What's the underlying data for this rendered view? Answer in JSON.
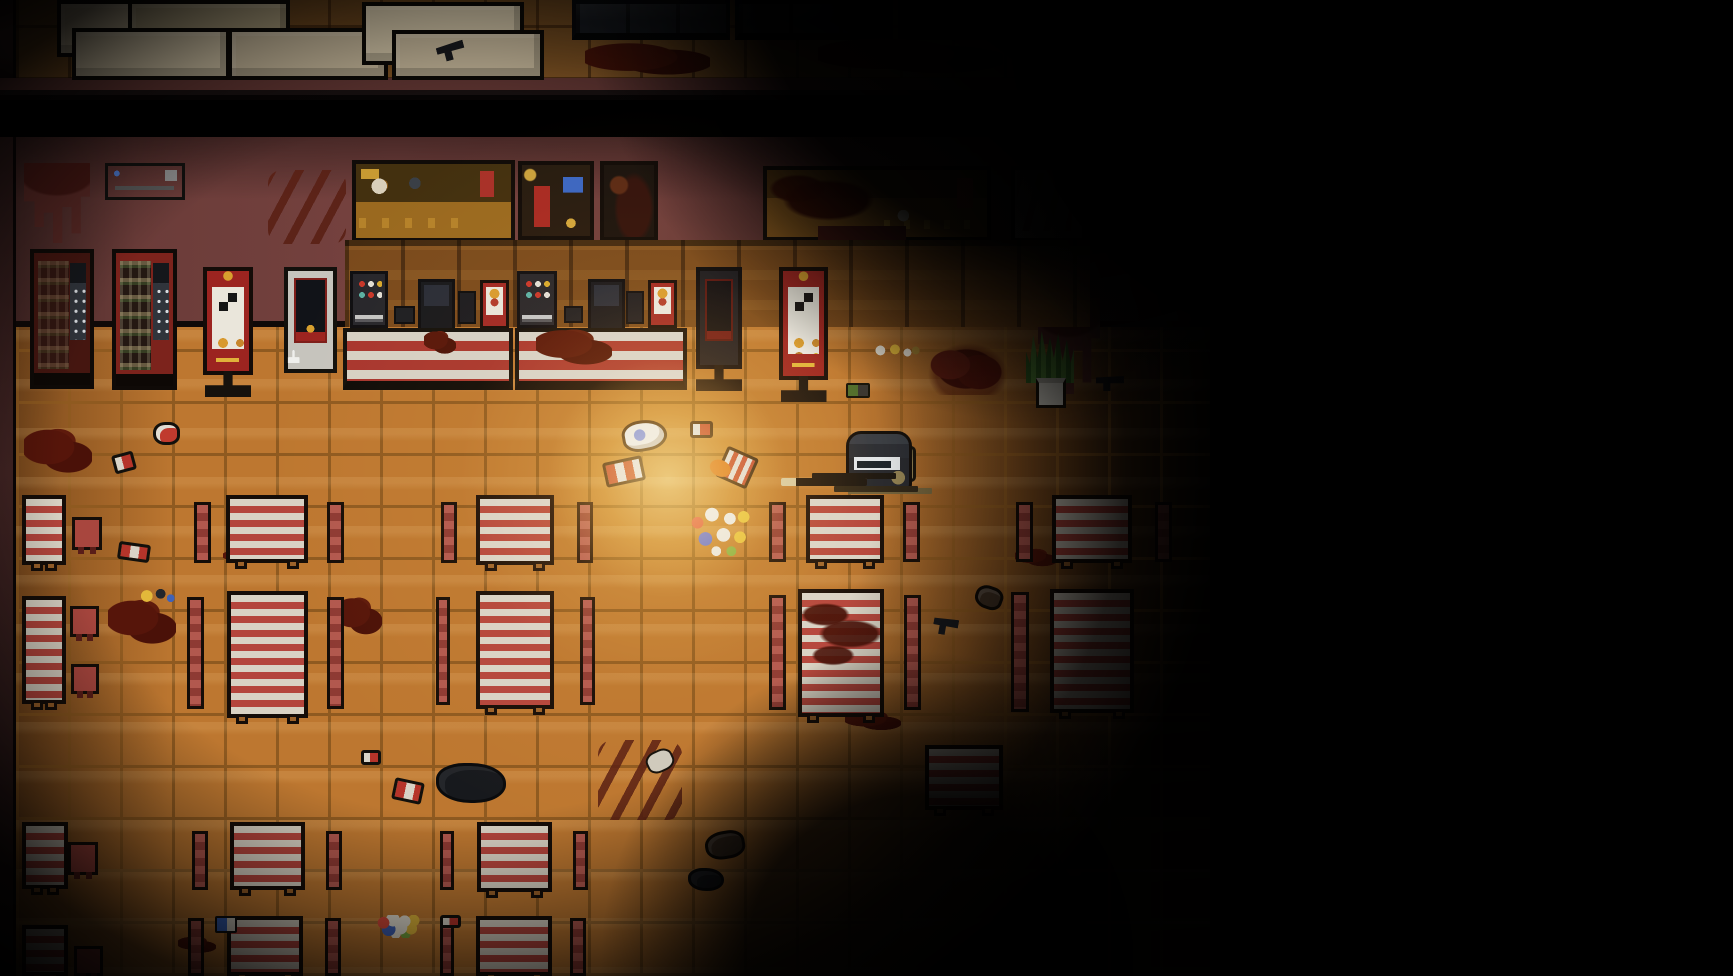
{
  "meta": {
    "scene": "top-down pixel-art fast-food restaurant interior, zombie-survival shooter",
    "lighting": "dark vignette with warm light pool around player"
  },
  "viewport": {
    "width": 1733,
    "height": 976
  },
  "palette": {
    "floor_tile": "#bd7730",
    "floor_grout": "#8f5a20",
    "wall": "#6b3c39",
    "table_stripe_red": "#b4453c",
    "table_stripe_white": "#d9d2c4",
    "bench_red": "#a84b43",
    "counter_stripe_red": "#a8362e",
    "counter_stripe_white": "#d6d0c3",
    "blood": "#4f1309",
    "wall_blood": "#5c2a26",
    "light_warm": "#ffcf7a",
    "vending_red": "#7c231c",
    "kiosk_red": "#9c2420",
    "plant_green": "#4d8033",
    "player_helmet": "#2c3138",
    "player_goggles": "#e2e5e7",
    "gun_suppressor_tan": "#d6c69a"
  },
  "entities": [
    {
      "t": "backroom-floor",
      "n": "backroom-floor",
      "x": 16,
      "y": 0,
      "w": 1074,
      "h": 80
    },
    {
      "t": "wall-left",
      "n": "backroom-left-wall",
      "x": 0,
      "y": 0,
      "w": 16,
      "h": 80
    },
    {
      "t": "wall-band",
      "n": "backroom-wall",
      "x": 0,
      "y": 78,
      "w": 1090,
      "h": 22
    },
    {
      "t": "crate",
      "v": "a",
      "n": "crate",
      "x": 57,
      "y": 0,
      "w": 100,
      "h": 57
    },
    {
      "t": "crate",
      "v": "b",
      "n": "crate",
      "x": 128,
      "y": 0,
      "w": 162,
      "h": 60
    },
    {
      "t": "crate",
      "v": "c",
      "n": "crate",
      "x": 72,
      "y": 28,
      "w": 158,
      "h": 52
    },
    {
      "t": "crate",
      "v": "a",
      "n": "crate",
      "x": 228,
      "y": 28,
      "w": 160,
      "h": 52
    },
    {
      "t": "crate",
      "v": "c",
      "n": "crate",
      "x": 362,
      "y": 2,
      "w": 162,
      "h": 63
    },
    {
      "t": "crate",
      "v": "a",
      "n": "crate",
      "x": 392,
      "y": 30,
      "w": 152,
      "h": 50
    },
    {
      "t": "shelf",
      "n": "storage-shelf",
      "x": 572,
      "y": 0,
      "w": 158,
      "h": 40
    },
    {
      "t": "shelf",
      "n": "storage-shelf",
      "x": 735,
      "y": 0,
      "w": 158,
      "h": 40
    },
    {
      "t": "shelf",
      "n": "storage-shelf",
      "x": 898,
      "y": 0,
      "w": 152,
      "h": 40
    },
    {
      "t": "blood-smear",
      "n": "blood-smear",
      "x": 585,
      "y": 40,
      "w": 125,
      "h": 38
    },
    {
      "t": "blood-smear",
      "n": "blood-smear",
      "x": 818,
      "y": 35,
      "w": 185,
      "h": 42
    },
    {
      "t": "pistol",
      "n": "dropped-pistol",
      "x": 437,
      "y": 43,
      "w": 28,
      "h": 17,
      "r": -15
    },
    {
      "t": "room-floor",
      "n": "restaurant-floor",
      "x": 16,
      "y": 327,
      "w": 1194,
      "h": 649
    },
    {
      "t": "wall-top",
      "n": "restaurant-back-wall",
      "x": 16,
      "y": 137,
      "w": 1194,
      "h": 190
    },
    {
      "t": "wall-left",
      "n": "restaurant-left-wall",
      "x": 0,
      "y": 137,
      "w": 16,
      "h": 839
    },
    {
      "t": "ac-unit",
      "n": "air-conditioner",
      "x": 105,
      "y": 163,
      "w": 80,
      "h": 37
    },
    {
      "t": "blood-drip",
      "n": "wall-blood",
      "x": 24,
      "y": 163,
      "w": 66,
      "h": 80
    },
    {
      "t": "blood-diag",
      "n": "wall-blood",
      "x": 268,
      "y": 170,
      "w": 78,
      "h": 74
    },
    {
      "t": "board board-a",
      "n": "menu-board",
      "x": 352,
      "y": 160,
      "w": 163,
      "h": 82
    },
    {
      "t": "board board-b",
      "n": "menu-board",
      "x": 518,
      "y": 161,
      "w": 76,
      "h": 79
    },
    {
      "t": "board board-c",
      "n": "menu-board",
      "x": 600,
      "y": 161,
      "w": 58,
      "h": 80
    },
    {
      "t": "board board-d",
      "n": "menu-board",
      "x": 763,
      "y": 166,
      "w": 228,
      "h": 75
    },
    {
      "t": "board board-e",
      "n": "menu-board",
      "x": 1011,
      "y": 166,
      "w": 75,
      "h": 76
    },
    {
      "t": "blood-drip",
      "n": "wall-blood",
      "x": 818,
      "y": 226,
      "w": 88,
      "h": 72
    },
    {
      "t": "blood-drip",
      "n": "wall-blood",
      "x": 1038,
      "y": 298,
      "w": 62,
      "h": 96
    },
    {
      "t": "counter-back",
      "n": "back-counter",
      "x": 345,
      "y": 240,
      "w": 745,
      "h": 87
    },
    {
      "t": "dispenser",
      "n": "drink-dispenser",
      "x": 350,
      "y": 271,
      "w": 38,
      "h": 57
    },
    {
      "t": "dispenser",
      "n": "drink-dispenser",
      "x": 517,
      "y": 271,
      "w": 40,
      "h": 57
    },
    {
      "t": "sidepanel",
      "n": "counter-device",
      "x": 394,
      "y": 306,
      "w": 21,
      "h": 18
    },
    {
      "t": "sidepanel",
      "n": "counter-device",
      "x": 564,
      "y": 306,
      "w": 19,
      "h": 17
    },
    {
      "t": "register",
      "n": "cash-register",
      "x": 418,
      "y": 279,
      "w": 37,
      "h": 52
    },
    {
      "t": "register",
      "n": "cash-register",
      "x": 588,
      "y": 279,
      "w": 37,
      "h": 52
    },
    {
      "t": "tablet",
      "n": "card-terminal",
      "x": 458,
      "y": 291,
      "w": 18,
      "h": 33
    },
    {
      "t": "tablet",
      "n": "card-terminal",
      "x": 626,
      "y": 291,
      "w": 18,
      "h": 33
    },
    {
      "t": "menustand",
      "n": "counter-menu-stand",
      "x": 480,
      "y": 280,
      "w": 29,
      "h": 49
    },
    {
      "t": "menustand",
      "n": "counter-menu-stand",
      "x": 648,
      "y": 280,
      "w": 29,
      "h": 48
    },
    {
      "t": "counter-front",
      "n": "service-counter",
      "x": 343,
      "y": 328,
      "w": 170,
      "h": 62
    },
    {
      "t": "counter-front",
      "n": "service-counter",
      "x": 515,
      "y": 328,
      "w": 172,
      "h": 62
    },
    {
      "t": "vending dark",
      "n": "vending-machine",
      "x": 30,
      "y": 249,
      "w": 64,
      "h": 140
    },
    {
      "t": "vending",
      "n": "vending-machine",
      "x": 112,
      "y": 249,
      "w": 65,
      "h": 141
    },
    {
      "t": "kiosk-qr standed",
      "n": "order-kiosk-sign",
      "x": 203,
      "y": 267,
      "w": 50,
      "h": 108
    },
    {
      "t": "kiosk-white standed",
      "n": "self-order-kiosk",
      "x": 284,
      "y": 267,
      "w": 53,
      "h": 106
    },
    {
      "t": "kiosk-dark standed",
      "n": "self-order-kiosk-dark",
      "x": 696,
      "y": 267,
      "w": 46,
      "h": 102
    },
    {
      "t": "kiosk-qr standed",
      "n": "order-kiosk-sign",
      "x": 779,
      "y": 267,
      "w": 49,
      "h": 113
    },
    {
      "t": "blood-pool",
      "n": "blood-pool",
      "x": 24,
      "y": 427,
      "w": 68,
      "h": 50
    },
    {
      "t": "blood-pool",
      "n": "blood-pool",
      "x": 536,
      "y": 328,
      "w": 76,
      "h": 40
    },
    {
      "t": "blood-pool",
      "n": "blood-pool",
      "x": 424,
      "y": 330,
      "w": 32,
      "h": 26
    },
    {
      "t": "blood-pool",
      "n": "blood-pool",
      "x": 108,
      "y": 598,
      "w": 68,
      "h": 50
    },
    {
      "t": "blood-pool",
      "n": "blood-pool",
      "x": 336,
      "y": 596,
      "w": 46,
      "h": 42
    },
    {
      "t": "blood-diag",
      "n": "blood-streak",
      "x": 598,
      "y": 740,
      "w": 84,
      "h": 80
    },
    {
      "t": "blood-pool",
      "n": "blood-pool",
      "x": 845,
      "y": 710,
      "w": 56,
      "h": 22
    },
    {
      "t": "blood-pool",
      "n": "blood-pool",
      "x": 1015,
      "y": 548,
      "w": 42,
      "h": 20
    },
    {
      "t": "blood-pool",
      "n": "blood-pool",
      "x": 178,
      "y": 936,
      "w": 38,
      "h": 18
    },
    {
      "t": "blood-pool",
      "n": "blood-pool",
      "x": 223,
      "y": 550,
      "w": 34,
      "h": 14
    },
    {
      "t": "table",
      "n": "dining-table",
      "x": 22,
      "y": 495,
      "w": 44,
      "h": 70
    },
    {
      "t": "stool",
      "n": "stool",
      "x": 72,
      "y": 517,
      "w": 30,
      "h": 33
    },
    {
      "t": "table",
      "n": "dining-table",
      "x": 22,
      "y": 596,
      "w": 44,
      "h": 108
    },
    {
      "t": "stool",
      "n": "stool",
      "x": 70,
      "y": 606,
      "w": 29,
      "h": 31
    },
    {
      "t": "stool",
      "n": "stool",
      "x": 71,
      "y": 664,
      "w": 28,
      "h": 30
    },
    {
      "t": "table",
      "n": "dining-table",
      "x": 22,
      "y": 822,
      "w": 46,
      "h": 67
    },
    {
      "t": "stool",
      "n": "stool",
      "x": 68,
      "y": 842,
      "w": 30,
      "h": 33
    },
    {
      "t": "table",
      "n": "dining-table",
      "x": 22,
      "y": 925,
      "w": 46,
      "h": 51
    },
    {
      "t": "stool",
      "n": "stool",
      "x": 74,
      "y": 946,
      "w": 29,
      "h": 30
    },
    {
      "t": "bench",
      "n": "booth-bench",
      "x": 194,
      "y": 502,
      "w": 17,
      "h": 61
    },
    {
      "t": "table",
      "n": "dining-table",
      "x": 226,
      "y": 495,
      "w": 82,
      "h": 68
    },
    {
      "t": "bench",
      "n": "booth-bench",
      "x": 327,
      "y": 502,
      "w": 17,
      "h": 61
    },
    {
      "t": "bench",
      "n": "booth-bench",
      "x": 441,
      "y": 502,
      "w": 16,
      "h": 61
    },
    {
      "t": "table",
      "n": "dining-table",
      "x": 476,
      "y": 495,
      "w": 78,
      "h": 70
    },
    {
      "t": "bench",
      "n": "booth-bench",
      "x": 577,
      "y": 502,
      "w": 16,
      "h": 61
    },
    {
      "t": "bench",
      "n": "booth-bench",
      "x": 769,
      "y": 502,
      "w": 17,
      "h": 60
    },
    {
      "t": "table",
      "n": "dining-table",
      "x": 806,
      "y": 495,
      "w": 78,
      "h": 68
    },
    {
      "t": "bench",
      "n": "booth-bench",
      "x": 903,
      "y": 502,
      "w": 17,
      "h": 60
    },
    {
      "t": "bench",
      "n": "booth-bench",
      "x": 1016,
      "y": 502,
      "w": 17,
      "h": 60
    },
    {
      "t": "table",
      "n": "dining-table",
      "x": 1052,
      "y": 495,
      "w": 80,
      "h": 68
    },
    {
      "t": "bench",
      "n": "booth-bench",
      "x": 1155,
      "y": 502,
      "w": 17,
      "h": 60
    },
    {
      "t": "bench",
      "n": "booth-bench",
      "x": 187,
      "y": 597,
      "w": 17,
      "h": 112
    },
    {
      "t": "table",
      "n": "dining-table",
      "x": 227,
      "y": 591,
      "w": 81,
      "h": 127
    },
    {
      "t": "bench",
      "n": "booth-bench",
      "x": 327,
      "y": 597,
      "w": 17,
      "h": 112
    },
    {
      "t": "bench",
      "n": "booth-bench",
      "x": 436,
      "y": 597,
      "w": 14,
      "h": 108
    },
    {
      "t": "table",
      "n": "dining-table",
      "x": 476,
      "y": 591,
      "w": 78,
      "h": 118
    },
    {
      "t": "bench",
      "n": "booth-bench",
      "x": 580,
      "y": 597,
      "w": 15,
      "h": 108
    },
    {
      "t": "bench",
      "n": "booth-bench",
      "x": 769,
      "y": 595,
      "w": 17,
      "h": 115
    },
    {
      "t": "table bloody",
      "n": "dining-table-bloody",
      "x": 798,
      "y": 589,
      "w": 86,
      "h": 128
    },
    {
      "t": "bench",
      "n": "booth-bench",
      "x": 904,
      "y": 595,
      "w": 17,
      "h": 115
    },
    {
      "t": "bench",
      "n": "booth-bench",
      "x": 1011,
      "y": 592,
      "w": 18,
      "h": 120
    },
    {
      "t": "table",
      "n": "dining-table",
      "x": 1050,
      "y": 589,
      "w": 84,
      "h": 124
    },
    {
      "t": "bench",
      "n": "booth-bench",
      "x": 192,
      "y": 831,
      "w": 16,
      "h": 59
    },
    {
      "t": "table",
      "n": "dining-table",
      "x": 230,
      "y": 822,
      "w": 75,
      "h": 68
    },
    {
      "t": "bench",
      "n": "booth-bench",
      "x": 326,
      "y": 831,
      "w": 16,
      "h": 59
    },
    {
      "t": "bench",
      "n": "booth-bench",
      "x": 440,
      "y": 831,
      "w": 14,
      "h": 59
    },
    {
      "t": "table",
      "n": "dining-table",
      "x": 477,
      "y": 822,
      "w": 75,
      "h": 70
    },
    {
      "t": "bench",
      "n": "booth-bench",
      "x": 573,
      "y": 831,
      "w": 15,
      "h": 59
    },
    {
      "t": "table",
      "n": "dining-table",
      "x": 925,
      "y": 745,
      "w": 78,
      "h": 65
    },
    {
      "t": "bench",
      "n": "booth-bench",
      "x": 188,
      "y": 918,
      "w": 16,
      "h": 58
    },
    {
      "t": "table",
      "n": "dining-table",
      "x": 227,
      "y": 916,
      "w": 76,
      "h": 60
    },
    {
      "t": "bench",
      "n": "booth-bench",
      "x": 325,
      "y": 918,
      "w": 16,
      "h": 58
    },
    {
      "t": "bench",
      "n": "booth-bench",
      "x": 440,
      "y": 918,
      "w": 14,
      "h": 58
    },
    {
      "t": "table",
      "n": "dining-table",
      "x": 476,
      "y": 916,
      "w": 76,
      "h": 60
    },
    {
      "t": "bench",
      "n": "booth-bench",
      "x": 570,
      "y": 918,
      "w": 16,
      "h": 58
    },
    {
      "t": "shoe-red",
      "n": "dropped-shoe",
      "x": 153,
      "y": 422,
      "w": 27,
      "h": 23
    },
    {
      "t": "can",
      "n": "soda-can",
      "x": 113,
      "y": 453,
      "w": 22,
      "h": 19,
      "r": -15
    },
    {
      "t": "can-double",
      "n": "soda-cans",
      "x": 118,
      "y": 543,
      "w": 32,
      "h": 18,
      "r": 8
    },
    {
      "t": "litter-yellow",
      "n": "food-litter",
      "x": 133,
      "y": 585,
      "w": 46,
      "h": 22
    },
    {
      "t": "sneaker",
      "n": "dropped-sneaker",
      "x": 622,
      "y": 420,
      "w": 45,
      "h": 31,
      "r": -10
    },
    {
      "t": "can",
      "n": "soda-can",
      "x": 690,
      "y": 421,
      "w": 23,
      "h": 17
    },
    {
      "t": "can-double",
      "n": "soda-cans",
      "x": 604,
      "y": 459,
      "w": 40,
      "h": 25,
      "r": -12
    },
    {
      "t": "cup-spill",
      "n": "spilled-cup",
      "x": 720,
      "y": 451,
      "w": 34,
      "h": 33,
      "r": 24
    },
    {
      "t": "trash-pile",
      "n": "spilled-trash",
      "x": 686,
      "y": 503,
      "w": 72,
      "h": 58
    },
    {
      "t": "food-scraps",
      "n": "food-scraps",
      "x": 870,
      "y": 341,
      "w": 52,
      "h": 21
    },
    {
      "t": "can-green",
      "n": "crushed-can",
      "x": 846,
      "y": 383,
      "w": 24,
      "h": 15
    },
    {
      "t": "pistol",
      "n": "dropped-pistol",
      "x": 1096,
      "y": 376,
      "w": 28,
      "h": 15
    },
    {
      "t": "shoe-dark",
      "n": "dropped-shoe",
      "x": 975,
      "y": 586,
      "w": 28,
      "h": 23,
      "r": 20
    },
    {
      "t": "pistol",
      "n": "dropped-pistol",
      "x": 933,
      "y": 618,
      "w": 25,
      "h": 17,
      "r": 10
    },
    {
      "t": "can",
      "n": "soda-can",
      "x": 361,
      "y": 750,
      "w": 20,
      "h": 15
    },
    {
      "t": "can-double",
      "n": "bloody-cans",
      "x": 393,
      "y": 780,
      "w": 30,
      "h": 22,
      "r": 12
    },
    {
      "t": "bag",
      "n": "dropped-bag",
      "x": 436,
      "y": 763,
      "w": 70,
      "h": 40
    },
    {
      "t": "bone",
      "n": "debris",
      "x": 646,
      "y": 750,
      "w": 28,
      "h": 22,
      "r": -25
    },
    {
      "t": "trash-pile",
      "n": "spilled-trash",
      "x": 376,
      "y": 915,
      "w": 47,
      "h": 23
    },
    {
      "t": "can",
      "n": "soda-can",
      "x": 440,
      "y": 915,
      "w": 21,
      "h": 13
    },
    {
      "t": "litter-blue",
      "n": "litter",
      "x": 215,
      "y": 916,
      "w": 22,
      "h": 17
    },
    {
      "t": "shoe-dark",
      "n": "dropped-shoe",
      "x": 705,
      "y": 831,
      "w": 40,
      "h": 28,
      "r": -10
    },
    {
      "t": "bag",
      "n": "debris",
      "x": 688,
      "y": 868,
      "w": 36,
      "h": 23
    },
    {
      "t": "corpse",
      "n": "corpse",
      "x": 928,
      "y": 343,
      "w": 80,
      "h": 52
    },
    {
      "t": "plant",
      "n": "potted-plant-leaves",
      "x": 1026,
      "y": 331,
      "w": 48,
      "h": 52
    },
    {
      "t": "plant-pot",
      "n": "potted-plant-pot",
      "x": 1036,
      "y": 378,
      "w": 30,
      "h": 30
    },
    {
      "t": "backpack",
      "n": "player-backpack",
      "x": 892,
      "y": 446,
      "w": 24,
      "h": 36
    },
    {
      "t": "player",
      "n": "player-character",
      "x": 846,
      "y": 431,
      "w": 66,
      "h": 62
    }
  ]
}
